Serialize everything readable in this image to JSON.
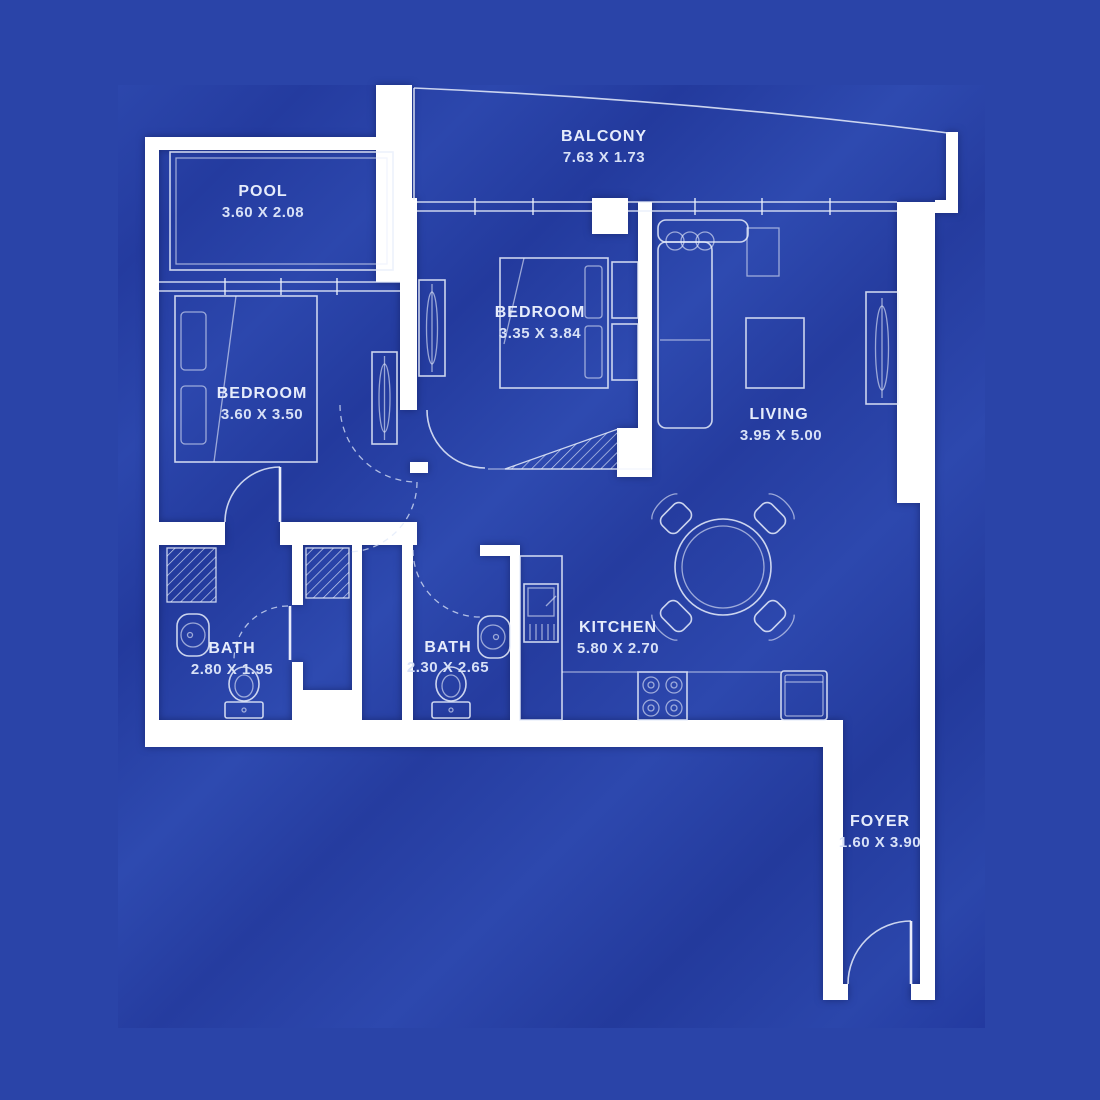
{
  "colors": {
    "background": "#2a44a8",
    "plan_band_dark": "#233a9d",
    "plan_band_light": "#2d49b0",
    "wall": "#ffffff",
    "line": "#e8eefc",
    "label_text": "#e6ecfb"
  },
  "rooms": {
    "balcony": {
      "name": "BALCONY",
      "dims": "7.63 X 1.73"
    },
    "pool": {
      "name": "POOL",
      "dims": "3.60 X 2.08"
    },
    "bedroom_center": {
      "name": "BEDROOM",
      "dims": "3.35 X 3.84"
    },
    "bedroom_left": {
      "name": "BEDROOM",
      "dims": "3.60 X 3.50"
    },
    "living": {
      "name": "LIVING",
      "dims": "3.95 X 5.00"
    },
    "kitchen": {
      "name": "KITCHEN",
      "dims": "5.80 X 2.70"
    },
    "bath_left": {
      "name": "BATH",
      "dims": "2.80 X 1.95"
    },
    "bath_center": {
      "name": "BATH",
      "dims": "2.30 X 2.65"
    },
    "foyer": {
      "name": "FOYER",
      "dims": "1.60 X 3.90"
    }
  }
}
